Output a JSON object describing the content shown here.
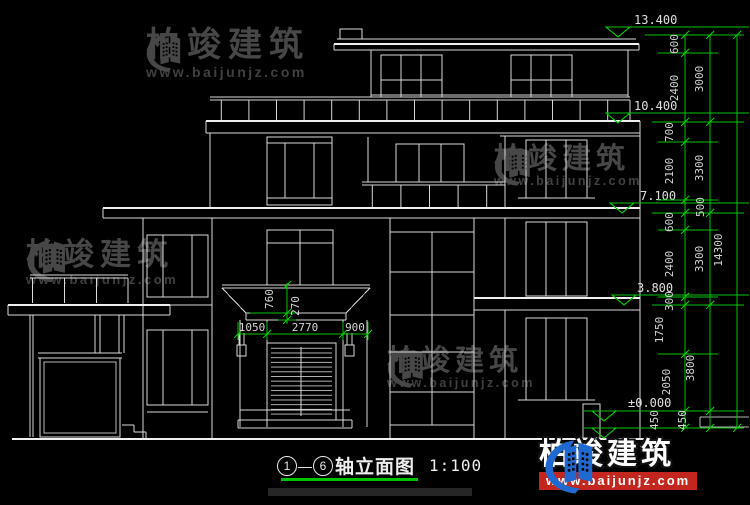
{
  "title": {
    "axis_start": "1",
    "axis_end": "6",
    "separator": "—",
    "label": "轴立面图",
    "scale": "1:100"
  },
  "levels": {
    "l13400": "13.400",
    "l10400": "10.400",
    "l7100": "7.100",
    "l3800": "3.800",
    "l0": "±0.000",
    "lm450": "-0.450"
  },
  "dims": {
    "inner": [
      "600",
      "2400",
      "700",
      "2100",
      "500",
      "600",
      "2400",
      "300",
      "1750",
      "2050",
      "450"
    ],
    "outer": [
      "3000",
      "3300",
      "3300",
      "3800",
      "450"
    ],
    "total": "14300",
    "canopy_v": [
      "760",
      "270"
    ],
    "entrance_h": [
      "1050",
      "2770",
      "900"
    ]
  },
  "watermark": {
    "brand": "柏竣建筑",
    "url": "www.baijunjz.com"
  },
  "logo": {
    "brand": "柏竣建筑",
    "url": "www.baijunjz.com"
  },
  "colors": {
    "background": "#000000",
    "line": "#d9d9d9",
    "dimension_green": "#00c400",
    "watermark_gray": "#474747",
    "logo_blue": "#1e6ad1",
    "logo_red": "#c3261f"
  }
}
